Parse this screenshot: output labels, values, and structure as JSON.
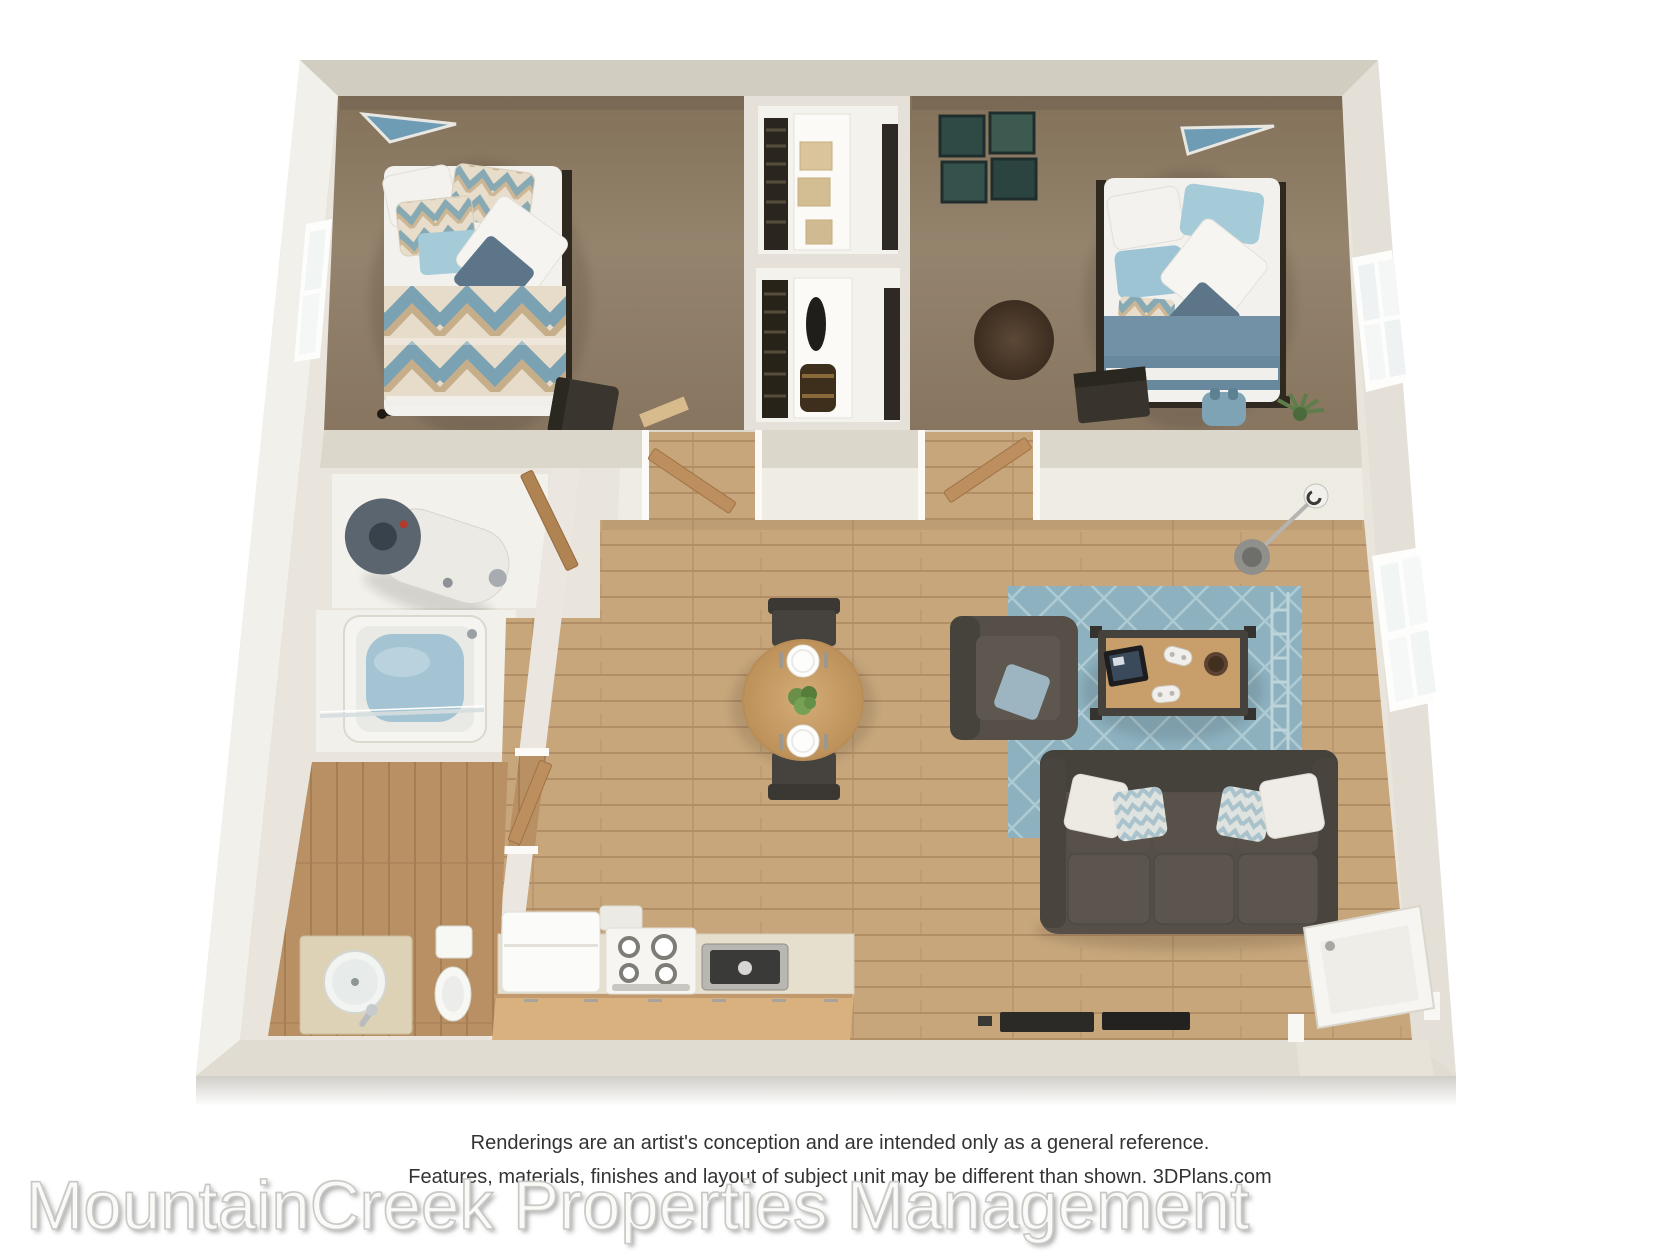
{
  "disclaimer": {
    "line1": "Renderings are an artist's conception and are intended only as a general reference.",
    "line2": "Features, materials, finishes and layout of subject unit may be different than shown. 3DPlans.com"
  },
  "watermark": "MountainCreek Properties Management",
  "colors": {
    "wall_outer": "#d8d3c7",
    "wall_face_top": "#d2cdc1",
    "wall_inner": "#e9e5dc",
    "wall_bright": "#f2f0ea",
    "carpet": "#8d7c67",
    "wood": "#c7a67b",
    "wood_dark": "#b99063",
    "rug": "#8db1bf",
    "sofa": "#554f48",
    "table_wood": "#c89e6b",
    "cabinet": "#d8b17f",
    "counter": "#e6dfcd",
    "accent_blue": "#6f9cb5",
    "blanket_blue": "#7291a6",
    "pillow_blue": "#a5cbd9",
    "slate": "#5d7588",
    "water": "#a5c4d3",
    "heater": "#5a6570",
    "door_wood": "#bd8f5e",
    "disclaimer_text": "#333333",
    "watermark_fill": "#fafaf8",
    "watermark_stroke": "#c8c8c4"
  }
}
